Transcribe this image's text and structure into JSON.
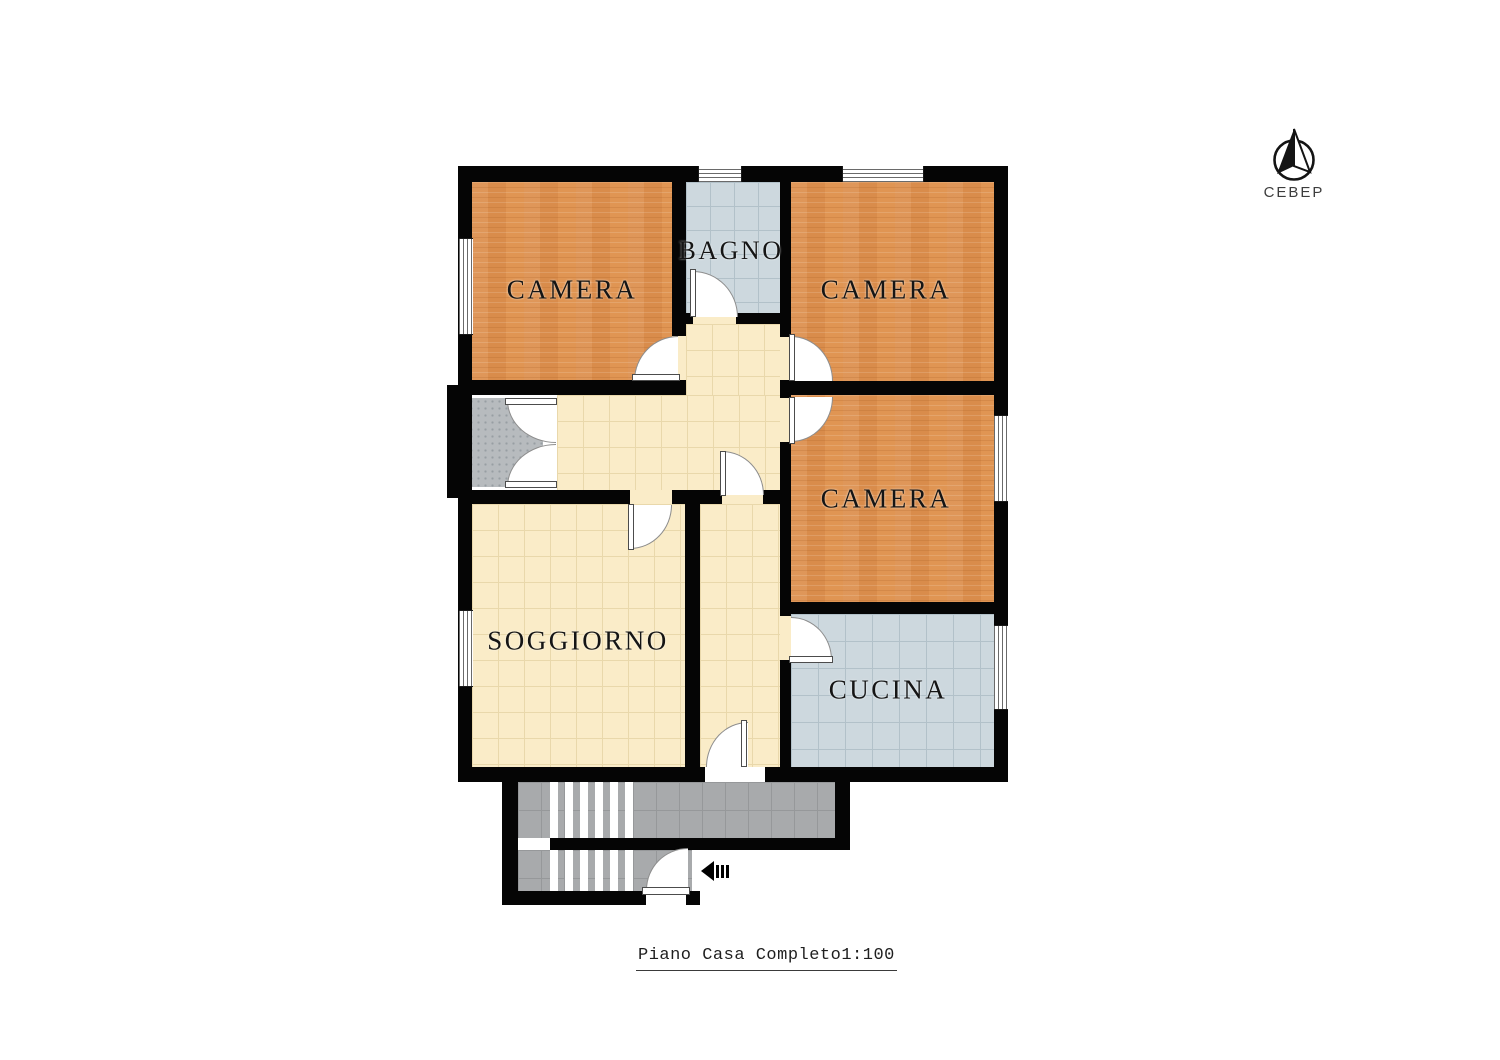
{
  "floorplan": {
    "rooms": [
      {
        "id": "camera-top-left",
        "label": "CAMERA"
      },
      {
        "id": "bagno",
        "label": "BAGNO"
      },
      {
        "id": "camera-top-right",
        "label": "CAMERA"
      },
      {
        "id": "camera-middle-right",
        "label": "CAMERA"
      },
      {
        "id": "soggiorno",
        "label": "SOGGIORNO"
      },
      {
        "id": "cucina",
        "label": "CUCINA"
      }
    ],
    "caption": {
      "title": "Piano Casa Completo",
      "scale": "1:100"
    },
    "compass": {
      "label": "СЕВЕР"
    },
    "colors": {
      "wall": "#050505",
      "bedroom_floor": "#dd9150",
      "bath_kitchen_floor": "#cdd8de",
      "hall_living_floor": "#faecc8",
      "porch_floor": "#b7bbbe",
      "stair_floor": "#a8aaac",
      "background": "#ffffff"
    }
  }
}
